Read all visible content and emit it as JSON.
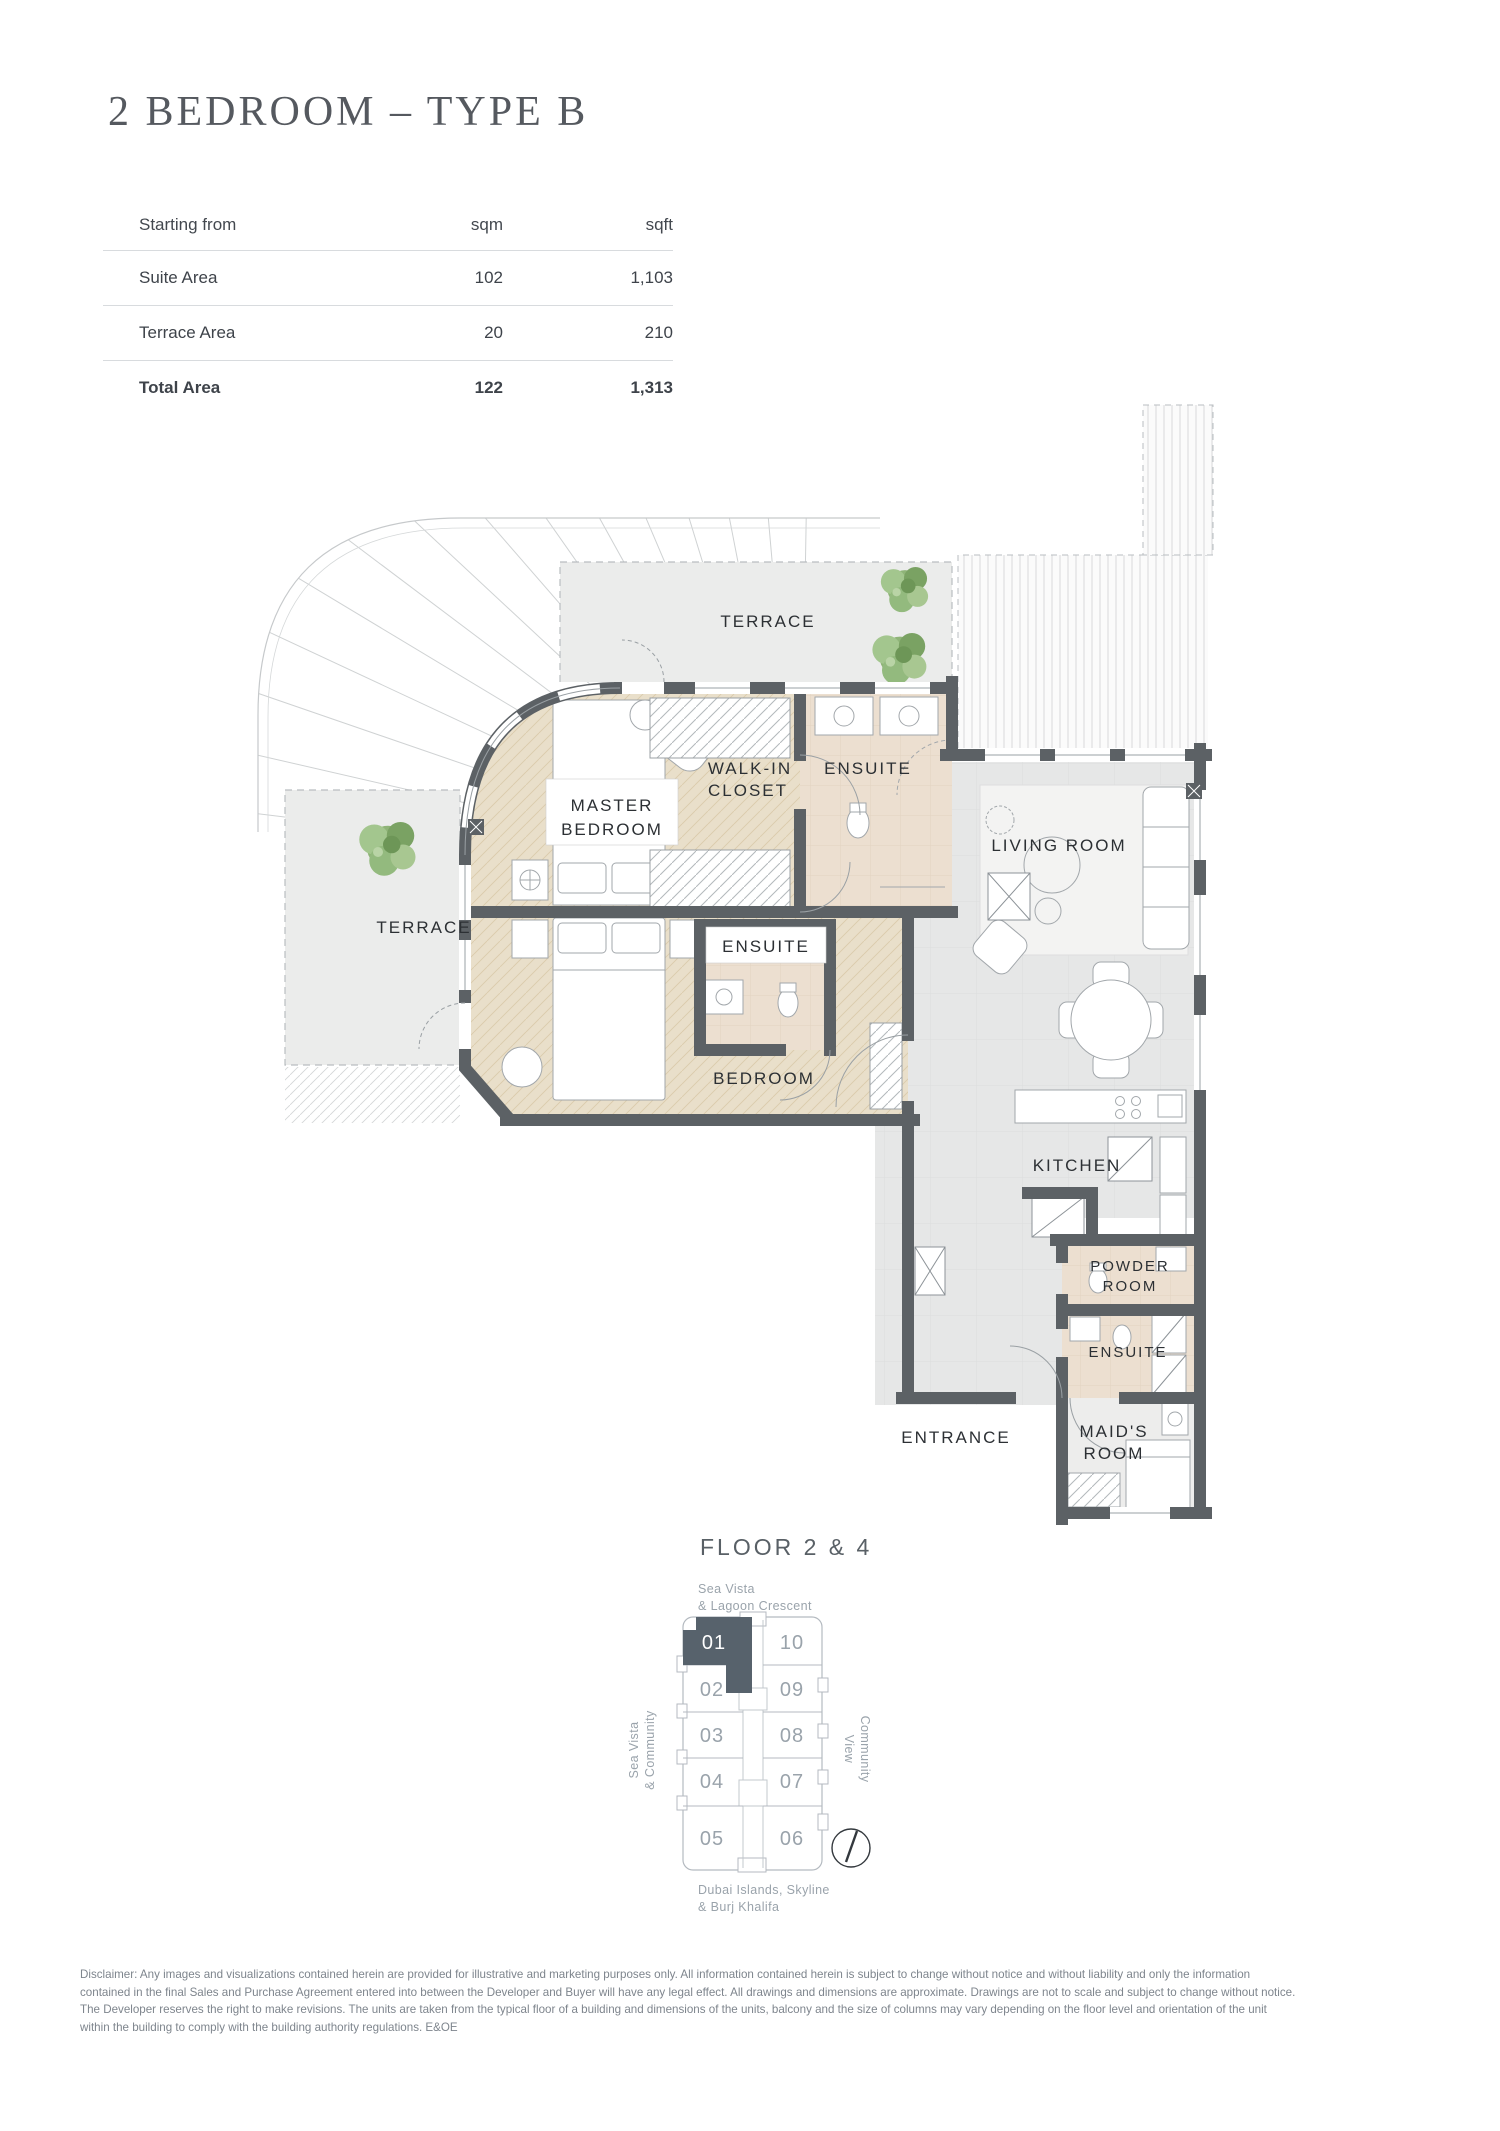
{
  "page": {
    "title": "2 BEDROOM – TYPE B"
  },
  "area_table": {
    "header": {
      "label": "Starting from",
      "col1": "sqm",
      "col2": "sqft"
    },
    "rows": [
      {
        "label": "Suite Area",
        "sqm": "102",
        "sqft": "1,103"
      },
      {
        "label": "Terrace Area",
        "sqm": "20",
        "sqft": "210"
      },
      {
        "label": "Total Area",
        "sqm": "122",
        "sqft": "1,313"
      }
    ]
  },
  "floor_plan": {
    "labels": {
      "terrace_top": "TERRACE",
      "walk_in_1": "WALK-IN",
      "walk_in_2": "CLOSET",
      "ensuite_master": "ENSUITE",
      "master_1": "MASTER",
      "master_2": "BEDROOM",
      "living_room": "LIVING ROOM",
      "terrace_left": "TERRACE",
      "ensuite_bedroom": "ENSUITE",
      "bedroom": "BEDROOM",
      "kitchen": "KITCHEN",
      "powder_1": "POWDER",
      "powder_2": "ROOM",
      "ensuite_maid": "ENSUITE",
      "maid_1": "MAID'S",
      "maid_2": "ROOM",
      "entrance": "ENTRANCE"
    }
  },
  "locator": {
    "title": "FLOOR 2 & 4",
    "top_label_1": "Sea Vista",
    "top_label_2": "& Lagoon Crescent",
    "left_label_1": "Sea Vista",
    "left_label_2": "& Community",
    "right_label_1": "Community",
    "right_label_2": "View",
    "bottom_label_1": "Dubai Islands, Skyline",
    "bottom_label_2": "& Burj Khalifa",
    "highlighted_unit": "01",
    "units": [
      {
        "label": "01"
      },
      {
        "label": "02"
      },
      {
        "label": "03"
      },
      {
        "label": "04"
      },
      {
        "label": "05"
      },
      {
        "label": "06"
      },
      {
        "label": "07"
      },
      {
        "label": "08"
      },
      {
        "label": "09"
      },
      {
        "label": "10"
      }
    ]
  },
  "disclaimer": {
    "lines": [
      "Disclaimer: Any images and visualizations contained herein are provided for illustrative and marketing purposes only. All information contained herein is subject to change without notice and without liability and only the information",
      "contained in the final Sales and Purchase Agreement entered into between the Developer and Buyer will have any legal effect. All drawings and dimensions are approximate. Drawings are not to scale and subject to change without notice.",
      "The Developer reserves the right to make revisions. The units are taken from the typical floor of a building and dimensions of the units, balcony and the size of columns may vary depending on the floor level and orientation of the unit",
      "within the building to comply with the building authority regulations. E&OE"
    ]
  },
  "colors": {
    "wall": "#5c6165",
    "wood_floor": "#e9dfca",
    "tile_floor": "#e6e7e7",
    "bath_floor": "#ecdfd0",
    "terrace_fill": "#ebeceb",
    "tree_green": "#8fb478",
    "unit_highlight": "#57626c",
    "text_dark": "#2c3034",
    "text_gray": "#9aa3ab"
  }
}
